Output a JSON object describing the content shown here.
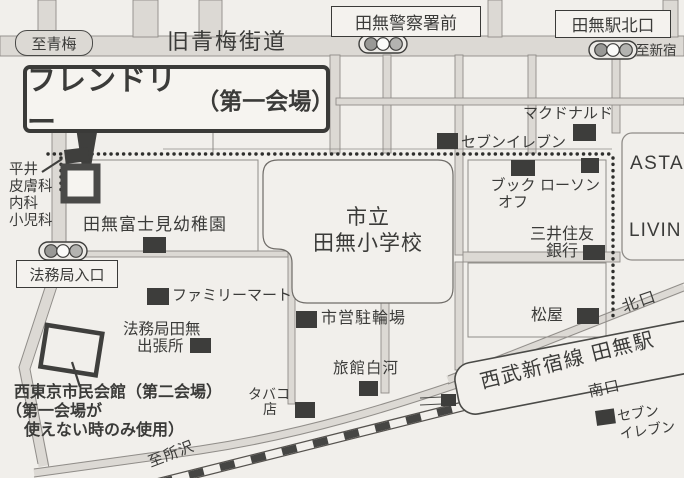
{
  "map": {
    "top": {
      "to_ome": "至青梅",
      "old_ome_kaido": "旧青梅街道",
      "police_sign": "田無警察署前",
      "station_north_sign": "田無駅北口",
      "to_shinjuku": "至新宿"
    },
    "venue": {
      "name": "フレンドリー",
      "hall": "（第一会場）"
    },
    "clinic": {
      "line1": "平井",
      "line2": "皮膚科",
      "line3": "内科",
      "line4": "小児科"
    },
    "places": {
      "kindergarten": "田無富士見幼稚園",
      "school_line1": "市立",
      "school_line2": "田無小学校",
      "seven_eleven_north": "セブンイレブン",
      "mcdonalds": "マクドナルド",
      "bookoff_line1": "ブック",
      "bookoff_line2": "オフ",
      "lawson": "ローソン",
      "asta": "ASTA",
      "livin": "LIVIN",
      "smbc_line1": "三井住友",
      "smbc_line2": "銀行",
      "matsuya": "松屋",
      "bicycle_parking": "市営駐輪場",
      "ryokan_shirakawa": "旅館白河",
      "tobacco_line1": "タバコ",
      "tobacco_line2": "店",
      "family_mart": "ファミリーマート",
      "homukyoku_entrance": "法務局入口",
      "homukyoku_branch_line1": "法務局田無",
      "homukyoku_branch_line2": "出張所",
      "seven_eleven_south_line1": "セブン",
      "seven_eleven_south_line2": "イレブン"
    },
    "station": {
      "name": "西武新宿線 田無駅",
      "north_exit": "北口",
      "south_exit": "南口"
    },
    "second_venue": {
      "line1": "西東京市民会館（第二会場）",
      "line2": "（第一会場が",
      "line3": "使えない時のみ使用）"
    },
    "to_tokorozawa": "至所沢",
    "colors": {
      "paper": "#f1efeb",
      "ink": "#3b3b39",
      "road_fill": "#dcd9d4",
      "marker": "#3d3d3b",
      "route_dots": "#2e2e2c"
    },
    "icons": {
      "building_marker": "filled-square",
      "traffic_light": "three-circles-capsule",
      "walking_route": "dotted-line",
      "railway": "hatched-band"
    }
  }
}
